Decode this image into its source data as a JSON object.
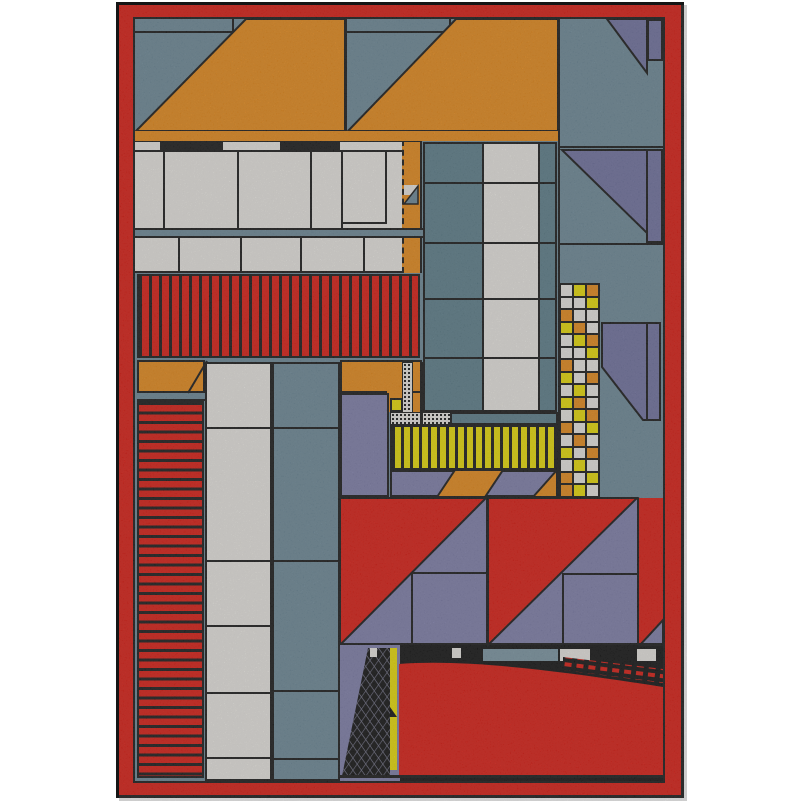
{
  "artwork": {
    "title": "Abstract geometric composition",
    "style": "constructivist-collage",
    "frame_color_name": "red",
    "page_background": "#ffffff"
  },
  "palette": {
    "red": "#e3180e",
    "orange": "#ef8d17",
    "yellow": "#f2e400",
    "white": "#f1efe9",
    "slate": "#6e8b9b",
    "slate_dark": "#5d808d",
    "slate_light": "#7d99a6",
    "purple": "#8181ae",
    "purple_dark": "#7173a3",
    "black": "#151515",
    "page": "#ffffff"
  },
  "mosaic": {
    "columns": 3,
    "rows": [
      "WYO",
      "WWY",
      "OWW",
      "YOW",
      "WYO",
      "WWY",
      "OWW",
      "YWO",
      "WYW",
      "YOW",
      "WYO",
      "OWY",
      "WOW",
      "YWO",
      "WYW",
      "OWY",
      "OYW"
    ],
    "legend": {
      "W": "white",
      "Y": "yellow",
      "O": "orange"
    }
  },
  "stripes": {
    "red_vertical_band": {
      "orientation": "vertical",
      "period_px": 10
    },
    "red_horizontal_block": {
      "orientation": "horizontal",
      "period_px": 9
    },
    "yellow_band": {
      "orientation": "vertical",
      "period_px": 9
    }
  }
}
